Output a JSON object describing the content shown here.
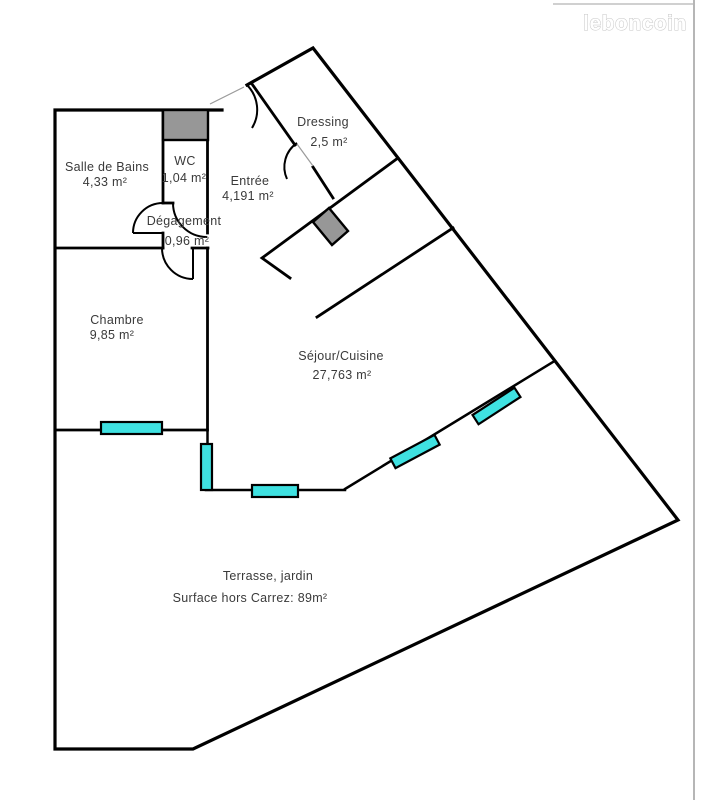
{
  "watermark": {
    "label": "leboncoin"
  },
  "colors": {
    "window": "#3fe1e1",
    "block": "#979797",
    "wall": "#000000",
    "text": "#3a3a3a",
    "watermark_fill": "#ffffff",
    "watermark_stroke": "#c6c6c6"
  },
  "rooms": [
    {
      "id": "salle-de-bains",
      "name": "Salle de Bains",
      "area": "4,33 m²"
    },
    {
      "id": "wc",
      "name": "WC",
      "area": "1,04 m²"
    },
    {
      "id": "entree",
      "name": "Entrée",
      "area": "4,191 m²"
    },
    {
      "id": "dressing",
      "name": "Dressing",
      "area": "2,5 m²"
    },
    {
      "id": "degagement",
      "name": "Dégagement",
      "area": "0,96 m²"
    },
    {
      "id": "chambre",
      "name": "Chambre",
      "area": "9,85 m²"
    },
    {
      "id": "sejour-cuisine",
      "name": "Séjour/Cuisine",
      "area": "27,763 m²"
    },
    {
      "id": "terrasse",
      "name": "Terrasse, jardin",
      "area": "Surface hors Carrez: 89m²"
    }
  ]
}
